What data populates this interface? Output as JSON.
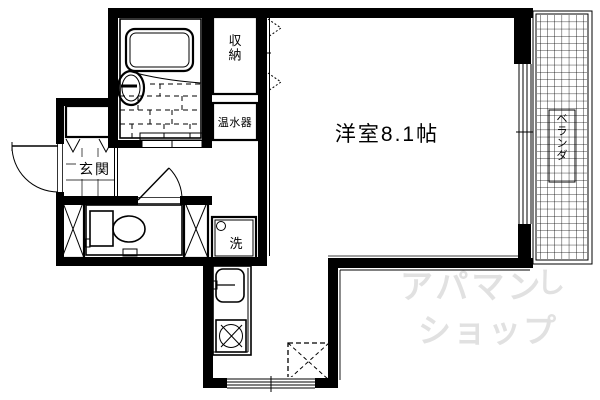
{
  "floorplan": {
    "rooms": {
      "main_room": {
        "label": "洋室8.1帖"
      },
      "storage": {
        "label": "収納"
      },
      "water_heater": {
        "label": "温水器"
      },
      "entrance": {
        "label": "玄関"
      },
      "washer": {
        "label": "洗"
      },
      "veranda": {
        "label": "ベランダ"
      }
    },
    "watermark": {
      "line1": "アパマン",
      "swirl": "し",
      "line2": "ショップ",
      "color": "#dedede"
    },
    "colors": {
      "wall": "#000000",
      "background": "#ffffff"
    }
  }
}
